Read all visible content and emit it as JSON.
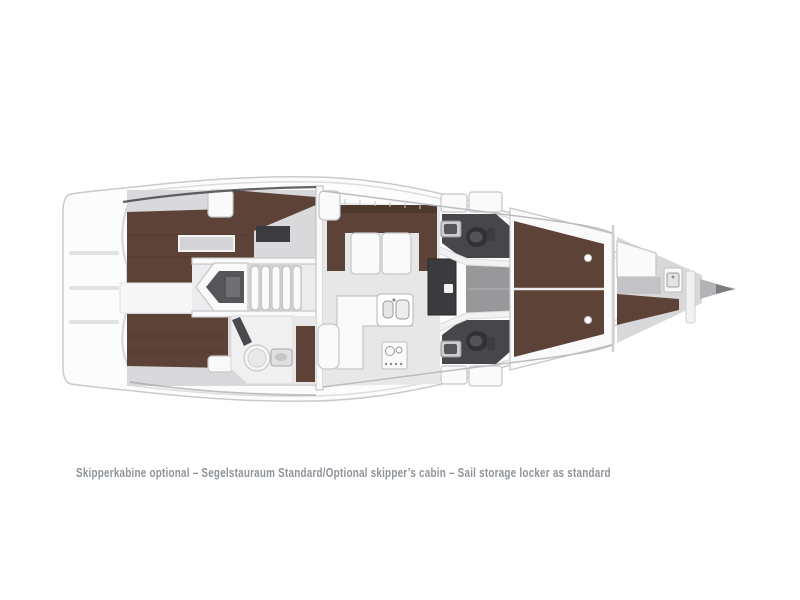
{
  "caption": {
    "text": "Skipperkabine optional – Segelstauraum Standard/Optional skipper’s cabin – Sail storage locker as standard"
  },
  "colors": {
    "background": "#ffffff",
    "hull-fill": "#fcfcfd",
    "hull-stroke": "#c9cacc",
    "deck-line": "#dddde0",
    "cabin-floor": "#d9d9db",
    "salon-floor": "#e7e7e8",
    "corridor-floor": "#98989b",
    "berth-brown": "#5d4337",
    "berth-brown-dark": "#4b372e",
    "head-floor-dark": "#47474b",
    "fixture-dark": "#323236",
    "furniture-white": "#fafafb",
    "furniture-stroke": "#c5c6c8",
    "engine-dark": "#55555a",
    "caption-text": "#8e939a"
  }
}
